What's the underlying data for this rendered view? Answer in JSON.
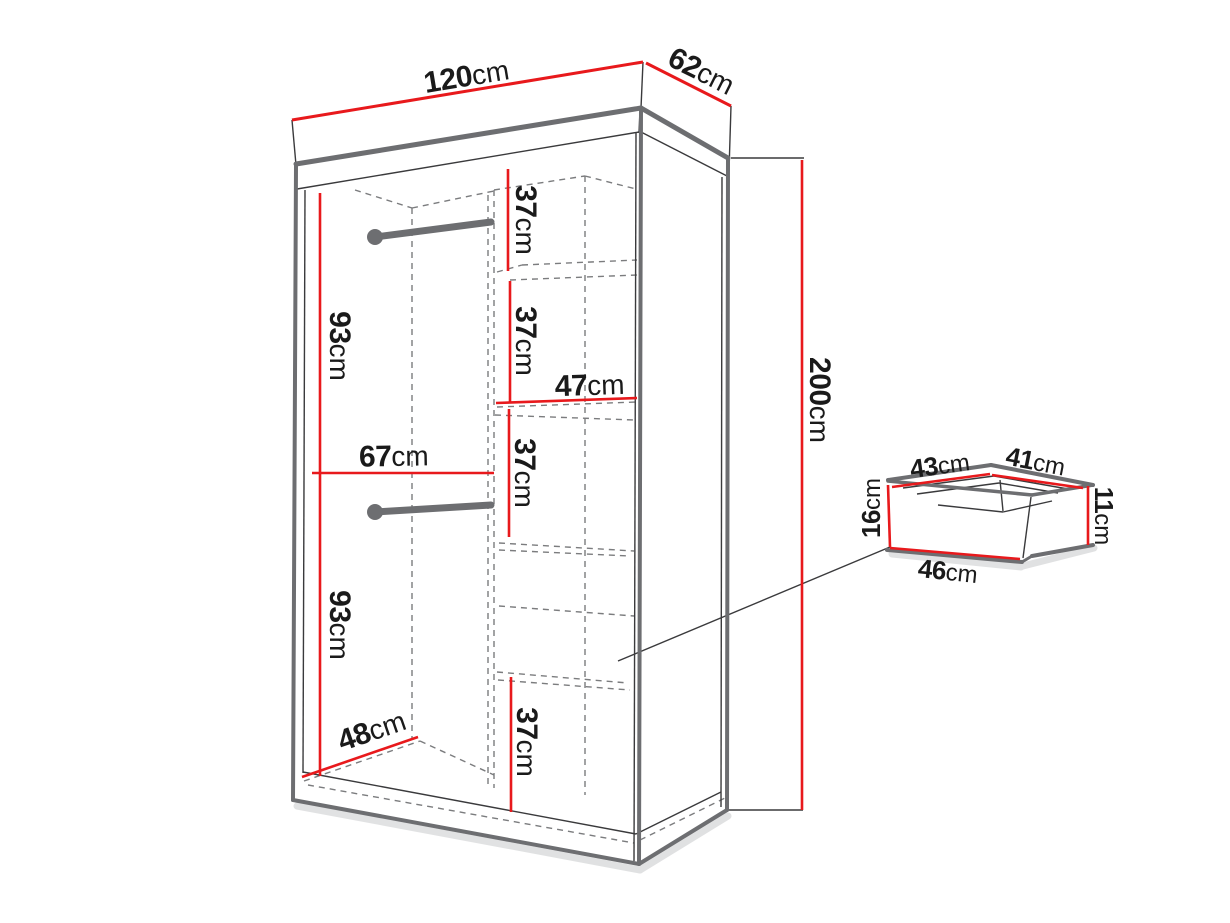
{
  "colors": {
    "dimension_red": "#e8191c",
    "outline_grey": "#6d6e71",
    "line_dark": "#3a3a3c",
    "dash_grey": "#7b7c7e",
    "shadow_grey": "#bcbec0",
    "text": "#1a1a1a",
    "background": "#ffffff"
  },
  "wardrobe": {
    "overall": {
      "width": {
        "value": "120",
        "unit": "cm"
      },
      "depth": {
        "value": "62",
        "unit": "cm"
      },
      "height": {
        "value": "200",
        "unit": "cm"
      }
    },
    "left_section": {
      "upper_hanging_height": {
        "value": "93",
        "unit": "cm"
      },
      "lower_hanging_height": {
        "value": "93",
        "unit": "cm"
      },
      "inner_width": {
        "value": "67",
        "unit": "cm"
      },
      "inner_depth": {
        "value": "48",
        "unit": "cm"
      }
    },
    "right_section": {
      "shelf_1_height": {
        "value": "37",
        "unit": "cm"
      },
      "shelf_2_height": {
        "value": "37",
        "unit": "cm"
      },
      "shelf_3_height": {
        "value": "37",
        "unit": "cm"
      },
      "shelf_4_height": {
        "value": "37",
        "unit": "cm"
      },
      "inner_width": {
        "value": "47",
        "unit": "cm"
      }
    }
  },
  "drawer": {
    "top_left_edge": {
      "value": "43",
      "unit": "cm"
    },
    "top_right_edge": {
      "value": "41",
      "unit": "cm"
    },
    "front_height": {
      "value": "16",
      "unit": "cm"
    },
    "inner_height": {
      "value": "11",
      "unit": "cm"
    },
    "bottom_width": {
      "value": "46",
      "unit": "cm"
    }
  }
}
